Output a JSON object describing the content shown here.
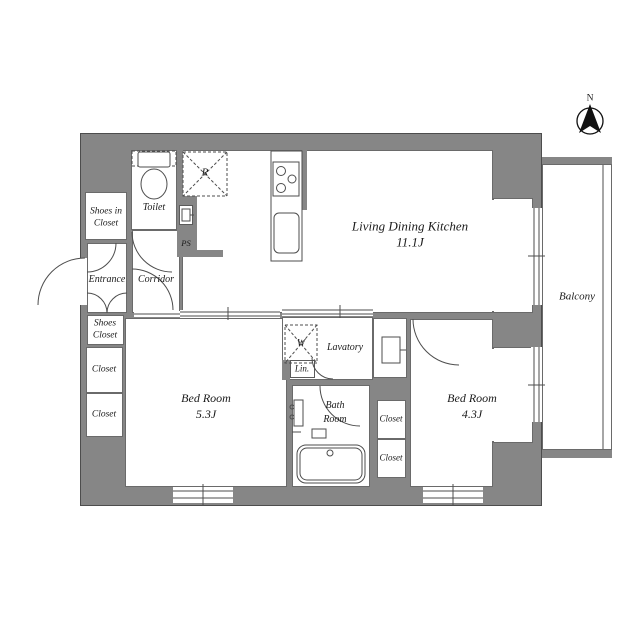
{
  "colors": {
    "wall": "#868686",
    "line": "#4d4d4d",
    "floor": "#ffffff"
  },
  "compass": {
    "north_label": "N"
  },
  "rooms": {
    "ldk": {
      "name": "Living Dining Kitchen",
      "size": "11.1J"
    },
    "bedroom_a": {
      "name": "Bed Room",
      "size": "5.3J"
    },
    "bedroom_b": {
      "name": "Bed Room",
      "size": "4.3J"
    },
    "toilet": {
      "name": "Toilet"
    },
    "entrance": {
      "name": "Entrance"
    },
    "corridor": {
      "name": "Corridor"
    },
    "lavatory": {
      "name": "Lavatory"
    },
    "bath": {
      "line1": "Bath",
      "line2": "Room"
    },
    "balcony": {
      "name": "Balcony"
    }
  },
  "storage": {
    "shoes_in_closet": {
      "line1": "Shoes in",
      "line2": "Closet"
    },
    "shoes_closet": {
      "line1": "Shoes",
      "line2": "Closet"
    },
    "closet_left_1": "Closet",
    "closet_left_2": "Closet",
    "closet_right_1": "Closet",
    "closet_right_2": "Closet",
    "linen": "Lin."
  },
  "symbols": {
    "refrigerator": "R",
    "washing_machine": "W",
    "pipe_space": "PS"
  }
}
